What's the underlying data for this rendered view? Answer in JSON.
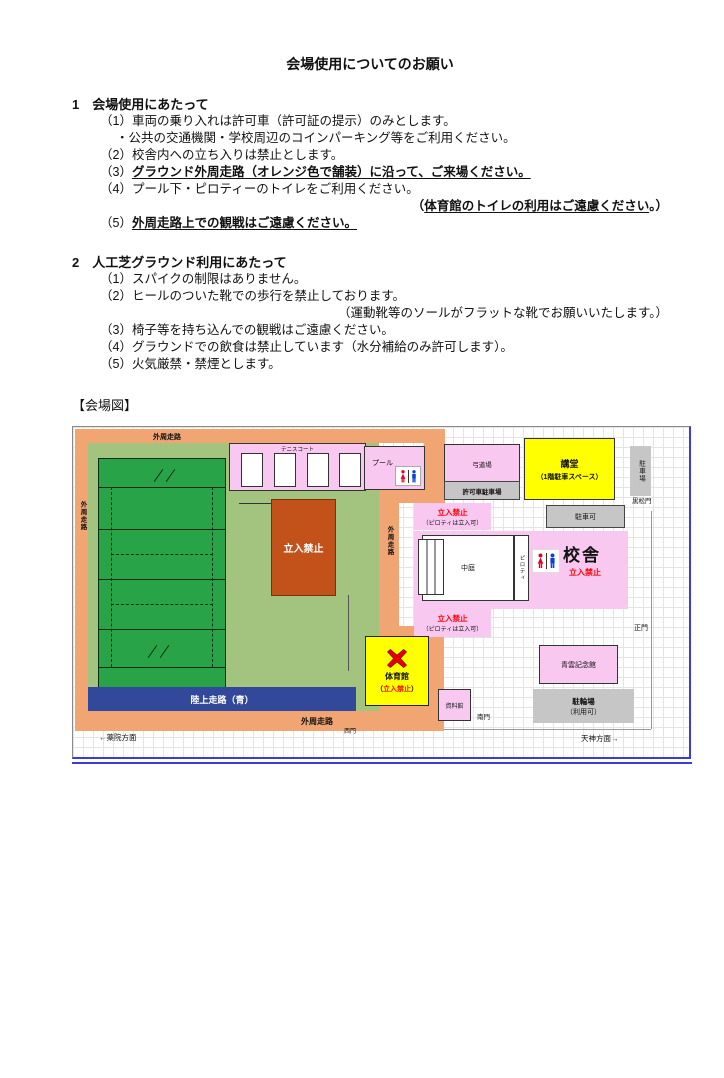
{
  "doc": {
    "title": "会場使用についてのお願い",
    "s1": {
      "heading": "1　会場使用にあたって",
      "i1": "（1）車両の乗り入れは許可車（許可証の提示）のみとします。",
      "i1_sub": "・公共の交通機関・学校周辺のコインパーキング等をご利用ください。",
      "i2": "（2）校舎内への立ち入りは禁止とします。",
      "i3_prefix": "（3）",
      "i3_strong": "グラウンド外周走路（オレンジ色で舗装）に沿って、ご来場ください。",
      "i4": "（4）プール下・ピロティーのトイレをご利用ください。",
      "i4_note_prefix": "（",
      "i4_note_strong": "体育館のトイレの利用はご遠慮ください",
      "i4_note_suffix": "。）",
      "i5_prefix": "（5）",
      "i5_strong": "外周走路上での観戦はご遠慮ください。"
    },
    "s2": {
      "heading": "2　人工芝グラウンド利用にあたって",
      "i1": "（1）スパイクの制限はありません。",
      "i2": "（2）ヒールのついた靴での歩行を禁止しております。",
      "i2_note": "（運動靴等のソールがフラットな靴でお願いいたします。）",
      "i3": "（3）椅子等を持ち込んでの観戦はご遠慮ください。",
      "i4": "（4）グラウンドでの飲食は禁止しています（水分補給のみ許可します）。",
      "i5": "（5）火気厳禁・禁煙とします。"
    },
    "map_caption": "【会場図】"
  },
  "map": {
    "outer_track_top": "外周走路",
    "outer_track_left": "外周走路",
    "outer_track_mid": "外周走路",
    "outer_track_bottom": "外周走路",
    "tennis": "テニスコート",
    "pool": "プール",
    "kyudo": "弓道場",
    "permit_parking": "許可車駐車場",
    "auditorium_line1": "講堂",
    "auditorium_line2": "（1階駐車スペース）",
    "parking_lot": "駐車場",
    "kuromatsu_gate": "黒松門",
    "parking_ok": "駐車可",
    "keepout_top": "立入禁止",
    "piloti_ok_top": "（ピロティは立入可）",
    "courtyard": "中庭",
    "piloti": "ピロティ",
    "school_bldg": "校舎",
    "school_keepout": "立入禁止",
    "keepout_bottom": "立入禁止",
    "piloti_ok_bottom": "（ピロティは立入可）",
    "main_gate": "正門",
    "keepout_block": "立入禁止",
    "gym_name": "体育館",
    "gym_keepout_prefix": "（",
    "gym_keepout": "立入禁止",
    "gym_keepout_suffix": "）",
    "memorial_hall": "青雲記念館",
    "archives": "資料館",
    "south_gate": "南門",
    "west_gate": "西門",
    "bike_parking_line1": "駐輪場",
    "bike_parking_line2": "（利用可）",
    "track_blue_label": "陸上走路（青）",
    "to_tenjin": "天神方面→",
    "to_yakuin": "←薬院方面"
  },
  "colors": {
    "track_orange": "#f0a573",
    "field_green": "#a2c47e",
    "pitch_green": "#29a347",
    "building_pink": "#f8c8f1",
    "gym_yellow": "#ffff00",
    "keepout_brown": "#c2511a",
    "track_blue": "#31489b",
    "gray_box": "#c6c6c6",
    "alert_red": "#ff0000",
    "wc_red": "#e1001e",
    "wc_blue": "#0b3fd6",
    "map_border_blue": "#3b3bdc"
  }
}
